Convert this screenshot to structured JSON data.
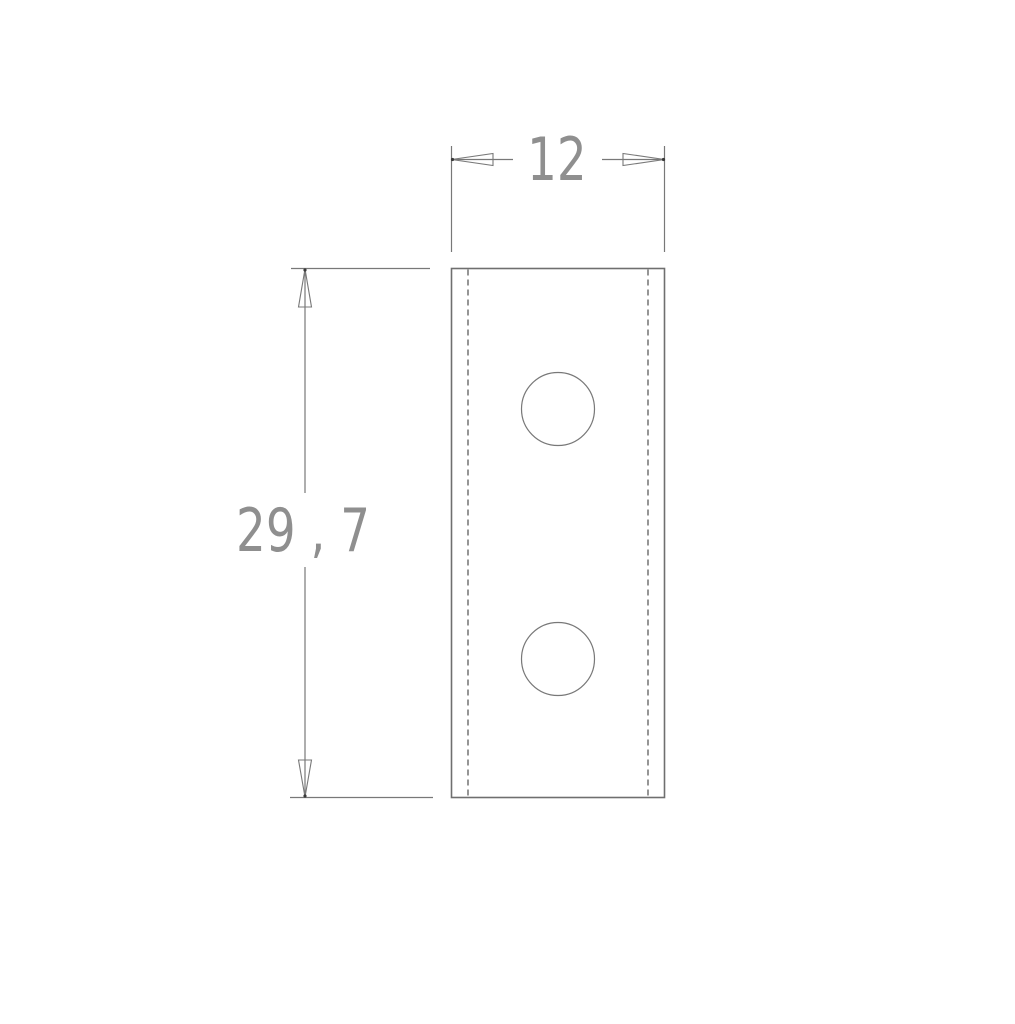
{
  "drawing": {
    "kind": "technical-drawing",
    "background_color": "#ffffff",
    "outline_color": "#6f6f6f",
    "hidden_line_color": "#4f4f4f",
    "dimension_text_color": "#8f8f8f",
    "part": {
      "shape": "rectangular plate",
      "hole_count": 2
    },
    "dimensions": {
      "width": {
        "label": "12",
        "value": 12
      },
      "height": {
        "label": "29 , 7",
        "value": 29.7
      }
    }
  }
}
